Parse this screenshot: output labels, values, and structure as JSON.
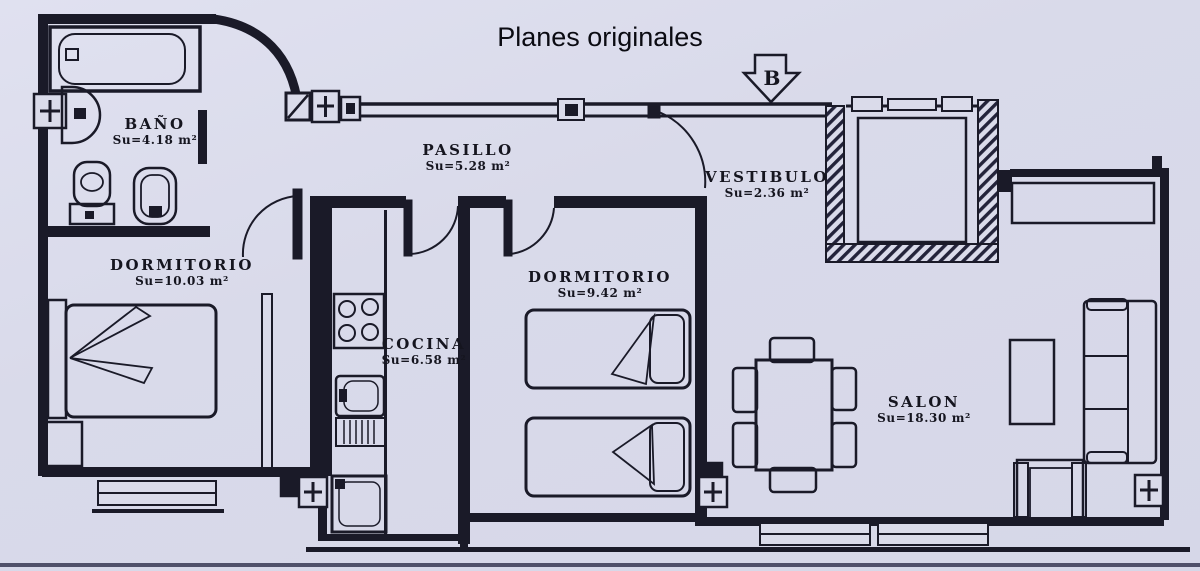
{
  "title": "Planes originales",
  "orientation_marker": "B",
  "rooms": {
    "bano": {
      "name": "BAÑO",
      "area": "Su=4.18 m²"
    },
    "pasillo": {
      "name": "PASILLO",
      "area": "Su=5.28 m²"
    },
    "vestibulo": {
      "name": "VESTIBULO",
      "area": "Su=2.36 m²"
    },
    "dormitorio1": {
      "name": "DORMITORIO",
      "area": "Su=10.03 m²"
    },
    "dormitorio2": {
      "name": "DORMITORIO",
      "area": "Su=9.42 m²"
    },
    "cocina": {
      "name": "COCINA",
      "area": "Su=6.58 m²"
    },
    "salon": {
      "name": "SALON",
      "area": "Su=18.30 m²"
    }
  },
  "colors": {
    "paper": "#dadbea",
    "ink": "#1a1a28",
    "hatch": "#23233a"
  }
}
